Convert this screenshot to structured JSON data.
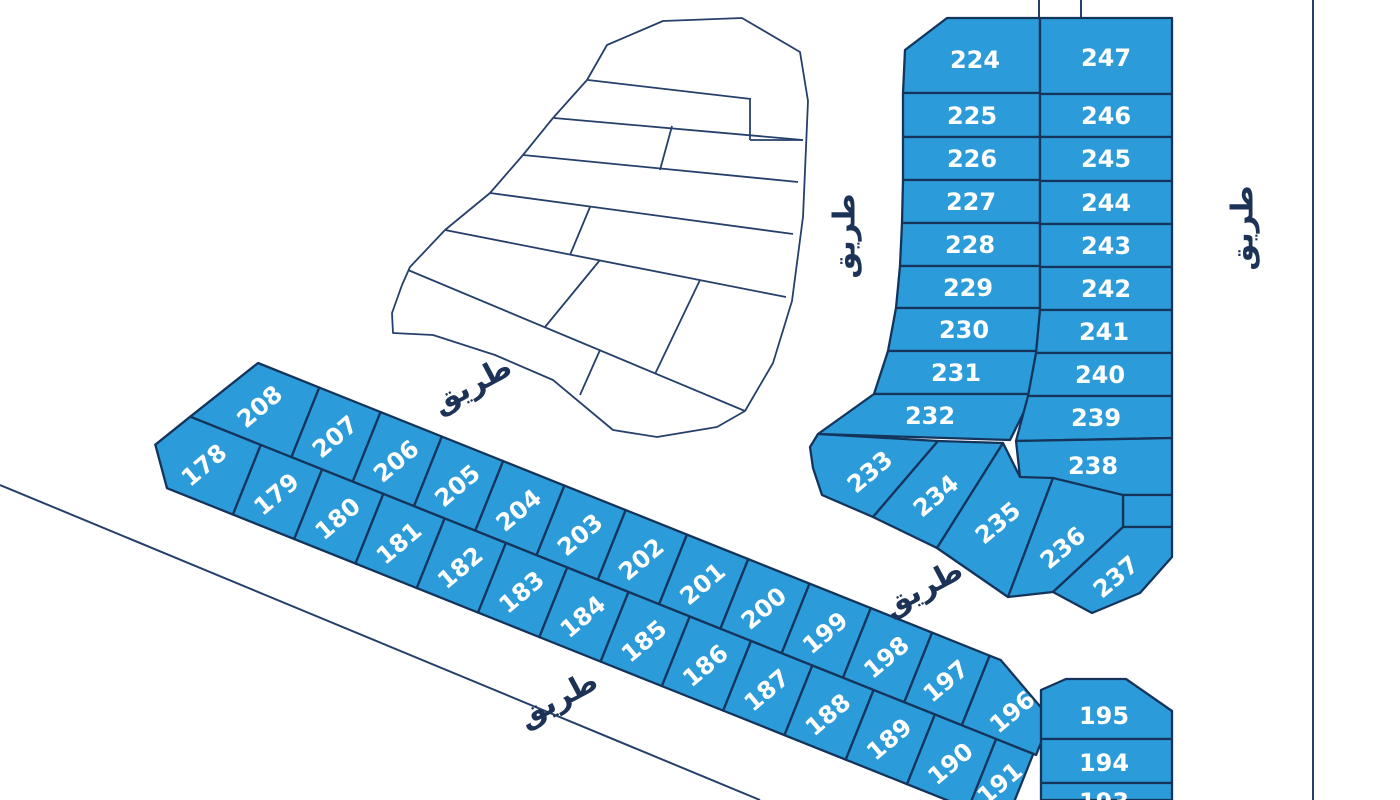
{
  "style": {
    "parcel_fill": "#2B9CD9",
    "parcel_stroke": "#14345C",
    "line_color": "#26406B",
    "road_text_color": "#1C3257",
    "label_color": "#FFFFFF",
    "background": "#FFFFFF",
    "parcel_stroke_w": 2.3,
    "outline_w": 1.8,
    "road_line_w": 2,
    "num_size": 24,
    "road_size": 30
  },
  "map": {
    "roads": [
      {
        "label": "طريق",
        "x": 845,
        "y": 236,
        "rot": -90
      },
      {
        "label": "طريق",
        "x": 1243,
        "y": 228,
        "rot": -90
      },
      {
        "label": "طريق",
        "x": 472,
        "y": 385,
        "rot": -28
      },
      {
        "label": "طريق",
        "x": 558,
        "y": 699,
        "rot": -28
      },
      {
        "label": "طريق",
        "x": 923,
        "y": 588,
        "rot": -28
      }
    ],
    "lines": [
      {
        "name": "road-line-southwest",
        "pts": [
          0,
          485,
          760,
          800
        ]
      },
      {
        "name": "road-line-east",
        "pts": [
          1313,
          0,
          1313,
          800
        ]
      },
      {
        "name": "boundary-stub-left",
        "pts": [
          1039,
          0,
          1039,
          18
        ]
      },
      {
        "name": "boundary-stub-right",
        "pts": [
          1081,
          0,
          1081,
          17
        ]
      }
    ],
    "white_zone": {
      "outline": "M663,21 L607,45 L587,80 L553,118 L523,155 L490,193 L445,230 L410,267 L402,285 L392,313 L393,333 L433,335 L495,355 L553,380 L613,430 L657,437 L717,427 L745,411 L773,363 L792,301 L803,217 L808,101 L800,52 L742,18 Z",
      "inner_lines": [
        [
          588,
          80,
          751,
          99
        ],
        [
          554,
          118,
          803,
          140
        ],
        [
          523,
          155,
          798,
          182
        ],
        [
          490,
          193,
          793,
          234
        ],
        [
          445,
          230,
          786,
          297
        ],
        [
          408,
          270,
          745,
          411
        ],
        [
          750,
          98,
          750,
          140
        ],
        [
          750,
          140,
          803,
          140
        ],
        [
          672,
          126,
          660,
          170
        ],
        [
          590,
          207,
          570,
          255
        ],
        [
          600,
          260,
          545,
          327
        ],
        [
          700,
          280,
          655,
          374
        ],
        [
          600,
          350,
          580,
          395
        ]
      ]
    },
    "block_parcels": [
      {
        "n": "224",
        "pts": "905,50 947,18 1040,18 1040,93 903,93",
        "lx": 975,
        "ly": 60,
        "rot": 0
      },
      {
        "n": "225",
        "pts": "903,93 1040,93 1040,137 903,137",
        "lx": 972,
        "ly": 116,
        "rot": 0
      },
      {
        "n": "226",
        "pts": "903,137 1040,137 1040,180 903,180",
        "lx": 972,
        "ly": 159,
        "rot": 0
      },
      {
        "n": "227",
        "pts": "903,180 1040,180 1040,223 902,223",
        "lx": 971,
        "ly": 202,
        "rot": 0
      },
      {
        "n": "228",
        "pts": "902,223 1040,223 1040,266 900,266",
        "lx": 970,
        "ly": 245,
        "rot": 0
      },
      {
        "n": "229",
        "pts": "900,266 1040,266 1040,308 896,308",
        "lx": 968,
        "ly": 288,
        "rot": 0
      },
      {
        "n": "230",
        "pts": "896,308 1040,308 1038,351 888,351",
        "lx": 964,
        "ly": 330,
        "rot": 0
      },
      {
        "n": "231",
        "pts": "888,351 1038,351 1033,394 874,394",
        "lx": 956,
        "ly": 373,
        "rot": 0
      },
      {
        "n": "232",
        "pts": "874,394 1033,394 1010,440 818,434",
        "lx": 930,
        "ly": 416,
        "rot": 0
      },
      {
        "n": "247",
        "pts": "1040,18 1172,18 1172,94 1040,94",
        "lx": 1106,
        "ly": 58,
        "rot": 0
      },
      {
        "n": "246",
        "pts": "1040,94 1172,94 1172,137 1040,137",
        "lx": 1106,
        "ly": 116,
        "rot": 0
      },
      {
        "n": "245",
        "pts": "1040,137 1172,137 1172,181 1040,181",
        "lx": 1106,
        "ly": 159,
        "rot": 0
      },
      {
        "n": "244",
        "pts": "1040,181 1172,181 1172,224 1040,224",
        "lx": 1106,
        "ly": 203,
        "rot": 0
      },
      {
        "n": "243",
        "pts": "1040,224 1172,224 1172,267 1040,267",
        "lx": 1106,
        "ly": 246,
        "rot": 0
      },
      {
        "n": "242",
        "pts": "1040,267 1172,267 1172,310 1040,310",
        "lx": 1106,
        "ly": 289,
        "rot": 0
      },
      {
        "n": "241",
        "pts": "1040,310 1172,310 1172,353 1036,353",
        "lx": 1104,
        "ly": 332,
        "rot": 0
      },
      {
        "n": "240",
        "pts": "1036,353 1172,353 1172,396 1028,396",
        "lx": 1100,
        "ly": 375,
        "rot": 0
      },
      {
        "n": "239",
        "pts": "1028,396 1172,396 1172,438 1016,441",
        "lx": 1096,
        "ly": 418,
        "rot": 0
      },
      {
        "n": "238",
        "pts": "1016,441 1172,438 1172,495 1123,495 1020,477",
        "lx": 1093,
        "ly": 466,
        "rot": 0
      },
      {
        "n": "",
        "pts": "1123,495 1172,495 1172,527 1123,527",
        "lx": 1148,
        "ly": 511,
        "rot": 0
      },
      {
        "n": "233",
        "pts": "810,447 818,434 938,441 873,517 822,495 813,468",
        "lx": 870,
        "ly": 472,
        "rot": -40
      },
      {
        "n": "234",
        "pts": "938,441 1003,443 937,548 873,517",
        "lx": 936,
        "ly": 496,
        "rot": -40
      },
      {
        "n": "235",
        "pts": "1003,443 1020,477 1053,478 1008,597 937,548",
        "lx": 998,
        "ly": 523,
        "rot": -40
      },
      {
        "n": "236",
        "pts": "1053,478 1123,495 1123,527 1053,592 1008,597",
        "lx": 1063,
        "ly": 548,
        "rot": -40
      },
      {
        "n": "237",
        "pts": "1123,527 1172,527 1172,557 1140,593 1092,613 1053,592",
        "lx": 1116,
        "ly": 577,
        "rot": -40
      },
      {
        "n": "195",
        "pts": "1041,690 1066,679 1126,679 1172,711 1172,739 1041,739",
        "lx": 1104,
        "ly": 716,
        "rot": 0
      },
      {
        "n": "194",
        "pts": "1041,739 1172,739 1172,783 1041,783",
        "lx": 1104,
        "ly": 763,
        "rot": 0
      },
      {
        "n": "193",
        "pts": "1041,783 1172,783 1172,800 1041,800",
        "lx": 1104,
        "ly": 802,
        "rot": 0
      }
    ],
    "strip": {
      "tx": 258,
      "ty": 363,
      "angle": 21.8,
      "label_rot": -62,
      "parcels": [
        {
          "n": "208",
          "pts": "0,0 66,0 66,75 -43,75",
          "lx": 18,
          "ly": 40
        },
        {
          "n": "207",
          "pts": "66,0 132,0 132,75 66,75",
          "lx": 99,
          "ly": 40
        },
        {
          "n": "206",
          "pts": "132,0 198,0 198,75 132,75",
          "lx": 165,
          "ly": 40
        },
        {
          "n": "205",
          "pts": "198,0 264,0 264,75 198,75",
          "lx": 231,
          "ly": 40
        },
        {
          "n": "204",
          "pts": "264,0 330,0 330,75 264,75",
          "lx": 297,
          "ly": 40
        },
        {
          "n": "203",
          "pts": "330,0 396,0 396,75 330,75",
          "lx": 363,
          "ly": 40
        },
        {
          "n": "202",
          "pts": "396,0 462,0 462,75 396,75",
          "lx": 429,
          "ly": 40
        },
        {
          "n": "201",
          "pts": "462,0 528,0 528,75 462,75",
          "lx": 495,
          "ly": 40
        },
        {
          "n": "200",
          "pts": "528,0 594,0 594,75 528,75",
          "lx": 561,
          "ly": 40
        },
        {
          "n": "199",
          "pts": "594,0 660,0 660,75 594,75",
          "lx": 627,
          "ly": 40
        },
        {
          "n": "198",
          "pts": "660,0 726,0 726,75 660,75",
          "lx": 693,
          "ly": 40
        },
        {
          "n": "197",
          "pts": "726,0 788,0 788,75 726,75",
          "lx": 757,
          "ly": 40
        },
        {
          "n": "196",
          "pts": "788,0 800,0 868,36 868,75 788,75",
          "lx": 830,
          "ly": 44
        },
        {
          "n": "178",
          "pts": "-43,75 33,75 33,150 -38,150 -65,114",
          "lx": -12,
          "ly": 115
        },
        {
          "n": "179",
          "pts": "33,75 99,75 99,150 33,150",
          "lx": 66,
          "ly": 115
        },
        {
          "n": "180",
          "pts": "99,75 165,75 165,150 99,150",
          "lx": 132,
          "ly": 115
        },
        {
          "n": "181",
          "pts": "165,75 231,75 231,150 165,150",
          "lx": 198,
          "ly": 115
        },
        {
          "n": "182",
          "pts": "231,75 297,75 297,150 231,150",
          "lx": 264,
          "ly": 115
        },
        {
          "n": "183",
          "pts": "297,75 363,75 363,150 297,150",
          "lx": 330,
          "ly": 115
        },
        {
          "n": "184",
          "pts": "363,75 429,75 429,150 363,150",
          "lx": 396,
          "ly": 115
        },
        {
          "n": "185",
          "pts": "429,75 495,75 495,150 429,150",
          "lx": 462,
          "ly": 115
        },
        {
          "n": "186",
          "pts": "495,75 561,75 561,150 495,150",
          "lx": 528,
          "ly": 115
        },
        {
          "n": "187",
          "pts": "561,75 627,75 627,150 561,150",
          "lx": 594,
          "ly": 115
        },
        {
          "n": "188",
          "pts": "627,75 693,75 693,150 627,150",
          "lx": 660,
          "ly": 115
        },
        {
          "n": "189",
          "pts": "693,75 759,75 759,150 693,150",
          "lx": 726,
          "ly": 115
        },
        {
          "n": "190",
          "pts": "759,75 825,75 825,150 759,150",
          "lx": 792,
          "ly": 115
        },
        {
          "n": "191",
          "pts": "825,75 865,75 865,150 825,150",
          "lx": 845,
          "ly": 115
        }
      ]
    }
  }
}
